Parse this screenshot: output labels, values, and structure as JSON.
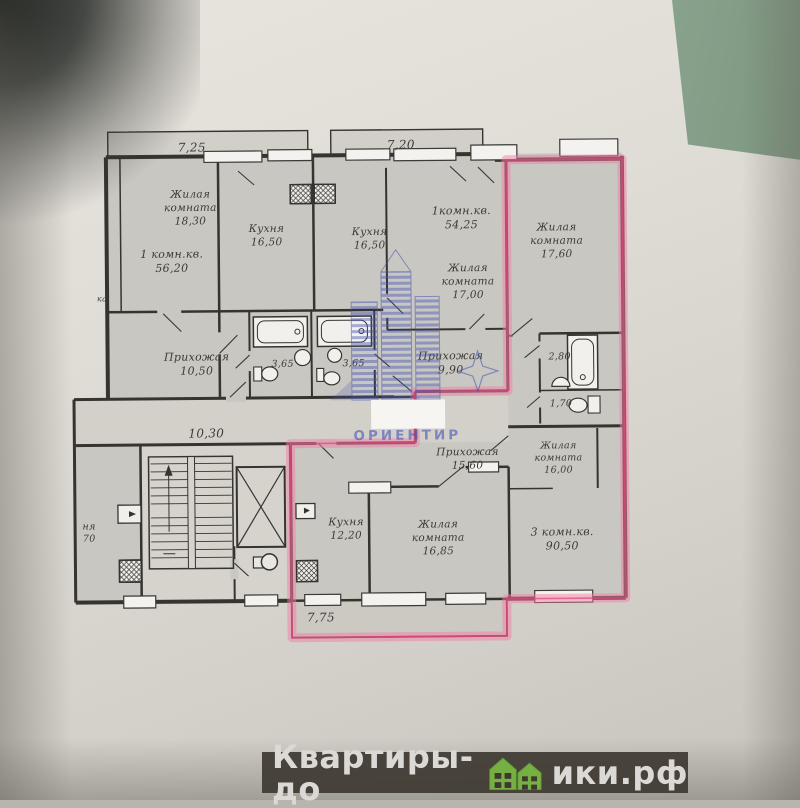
{
  "photo": {
    "paper_color": "#ddd9d3",
    "table_color": "#8ea695"
  },
  "floor_plan": {
    "stroke_color": "#35342f",
    "room_fill": "#c9c7c1",
    "highlight_color": "#f27da6",
    "highlight_edge": "#e0457b",
    "labels": [
      {
        "name": "dim-7-25",
        "lines": [
          "7,25"
        ],
        "x": 194,
        "y": 150,
        "size": 12
      },
      {
        "name": "room-zhilaya-18-30",
        "lines": [
          "Жилая",
          "комната",
          "18,30"
        ],
        "x": 192,
        "y": 196,
        "size": 10.5
      },
      {
        "name": "apt-1komn-56-20",
        "lines": [
          "1 комн.кв.",
          "56,20"
        ],
        "x": 173,
        "y": 256,
        "size": 11
      },
      {
        "name": "kitchen-16-50-left",
        "lines": [
          "Кухня",
          "16,50"
        ],
        "x": 268,
        "y": 231,
        "size": 10.5
      },
      {
        "name": "dim-7-20",
        "lines": [
          "7,20"
        ],
        "x": 403,
        "y": 149,
        "size": 12
      },
      {
        "name": "kitchen-16-50-mid",
        "lines": [
          "Кухня",
          "16,50"
        ],
        "x": 371,
        "y": 235,
        "size": 10.5
      },
      {
        "name": "apt-1komn-54-25",
        "lines": [
          "1комн.кв.",
          "54,25"
        ],
        "x": 463,
        "y": 215,
        "size": 11
      },
      {
        "name": "room-zhilaya-17-00",
        "lines": [
          "Жилая",
          "комната",
          "17,00"
        ],
        "x": 469,
        "y": 272,
        "size": 10.5
      },
      {
        "name": "room-zhilaya-17-60",
        "lines": [
          "Жилая",
          "комната",
          "17,60"
        ],
        "x": 558,
        "y": 232,
        "size": 10.5
      },
      {
        "name": "hall-10-50",
        "lines": [
          "Прихожая",
          "10,50"
        ],
        "x": 197,
        "y": 359,
        "size": 11
      },
      {
        "name": "bath-3-65-left",
        "lines": [
          "3,65"
        ],
        "x": 283,
        "y": 366,
        "size": 9.5
      },
      {
        "name": "bath-3-65-right",
        "lines": [
          "3,65"
        ],
        "x": 354,
        "y": 366,
        "size": 9.5
      },
      {
        "name": "hall-9-90",
        "lines": [
          "Прихожая",
          "9,90"
        ],
        "x": 451,
        "y": 360,
        "size": 11
      },
      {
        "name": "bath-2-80",
        "lines": [
          "2,80"
        ],
        "x": 560,
        "y": 361,
        "size": 9.5
      },
      {
        "name": "wc-1-70",
        "lines": [
          "1,70"
        ],
        "x": 561,
        "y": 408,
        "size": 9.5
      },
      {
        "name": "dim-10-30",
        "lines": [
          "10,30"
        ],
        "x": 206,
        "y": 436,
        "size": 12
      },
      {
        "name": "hall-15-60",
        "lines": [
          "Прихожая",
          "15,60"
        ],
        "x": 467,
        "y": 456,
        "size": 10.5
      },
      {
        "name": "room-zhilaya-16-00",
        "lines": [
          "Жилая",
          "комната",
          "16,00"
        ],
        "x": 558,
        "y": 450,
        "size": 9.5
      },
      {
        "name": "apt-3komn-90-50",
        "lines": [
          "3 комн.кв.",
          "90,50"
        ],
        "x": 561,
        "y": 537,
        "size": 11
      },
      {
        "name": "kitchen-12-20",
        "lines": [
          "Кухня",
          "12,20"
        ],
        "x": 345,
        "y": 525,
        "size": 10.5
      },
      {
        "name": "room-zhilaya-16-85",
        "lines": [
          "Жилая",
          "комната",
          "16,85"
        ],
        "x": 437,
        "y": 528,
        "size": 10.5
      },
      {
        "name": "dim-7-75",
        "lines": [
          "7,75"
        ],
        "x": 319,
        "y": 621,
        "size": 12
      },
      {
        "name": "partial-label-left",
        "lines": [
          "ня",
          "70"
        ],
        "x": 88,
        "y": 527,
        "size": 9.5
      },
      {
        "name": "partial-label-ka",
        "lines": [
          "ка"
        ],
        "x": 103,
        "y": 299,
        "size": 8
      }
    ]
  },
  "watermark_center": {
    "brand": "ОРИЕНТИР",
    "color": "#4353b4"
  },
  "watermark_bottom": {
    "prefix": "Квартиры-до",
    "suffix": "ики.рф",
    "full_text": "Квартиры-домики.рф",
    "bar_color": "#3e3831",
    "text_color": "#dbd9d5",
    "house_color": "#76b043"
  }
}
